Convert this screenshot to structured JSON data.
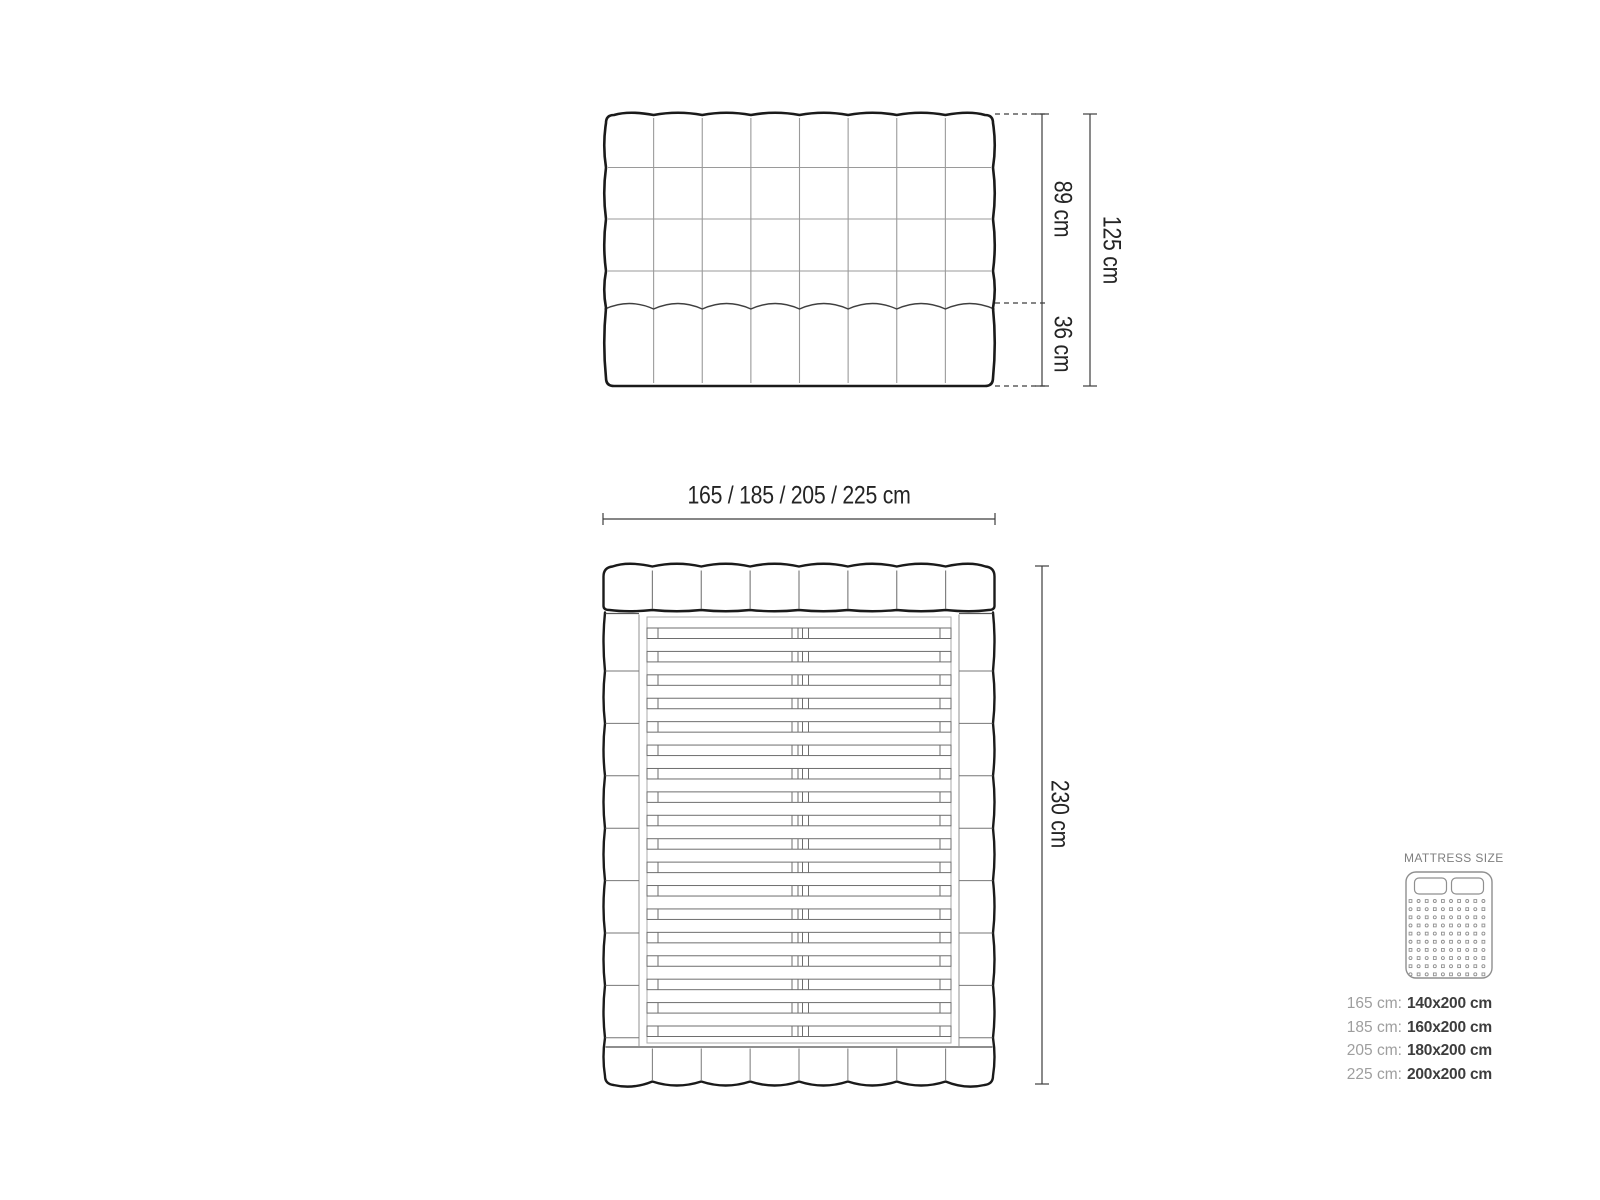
{
  "figure": {
    "headboard_front_view": {
      "tuft_columns": 8,
      "tuft_rows": 5,
      "upper_height_label": "89 cm",
      "lower_height_label": "36 cm",
      "total_height_label": "125 cm"
    },
    "top_view": {
      "width_options_label": "165 / 185 / 205 / 225 cm",
      "length_label": "230 cm",
      "slat_count": 18,
      "headboard_tuft_columns": 8,
      "footboard_tuft_columns": 8,
      "side_rail_segments": 9
    }
  },
  "legend": {
    "title": "MATTRESS SIZE",
    "rows": [
      {
        "label": "165 cm:",
        "value": "140x200 cm"
      },
      {
        "label": "185 cm:",
        "value": "160x200 cm"
      },
      {
        "label": "205 cm:",
        "value": "180x200 cm"
      },
      {
        "label": "225 cm:",
        "value": "200x200 cm"
      }
    ]
  },
  "colors": {
    "outline": "#1a1a1a",
    "grid_line": "#9a9a9a",
    "detail_line": "#6e6e6e",
    "divider_line": "#777777",
    "scallop_line": "#3f3f3f",
    "dimension_line": "#3d3d3d",
    "dimension_text": "#242424",
    "legend_muted": "#9e9e9e",
    "legend_value": "#3d3d3d",
    "legend_icon": "#8f8f8f",
    "background": "#ffffff"
  }
}
